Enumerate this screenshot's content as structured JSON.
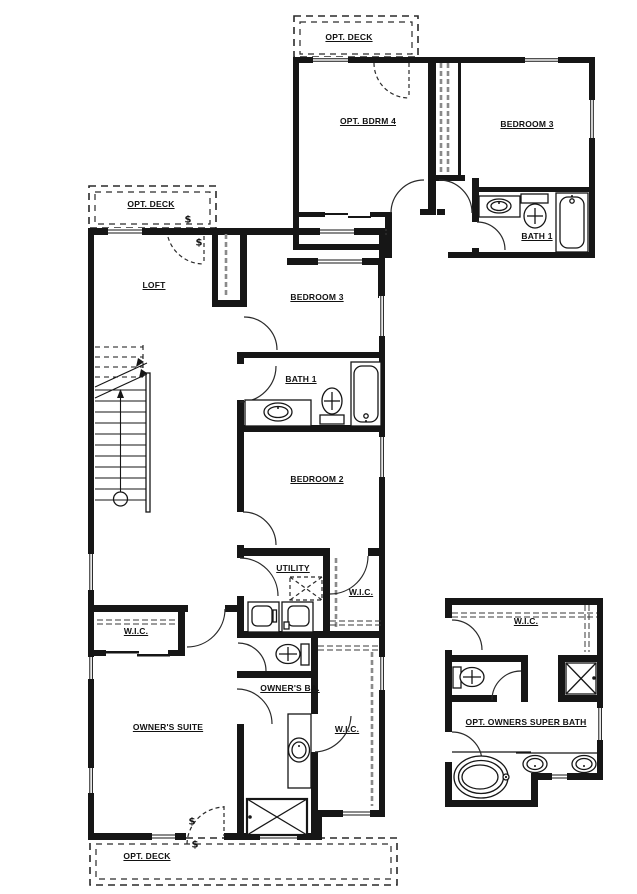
{
  "colors": {
    "walls": "#161616",
    "background": "#ffffff",
    "dash_gray": "#8a8a8a"
  },
  "plans": {
    "upper": {
      "labels": {
        "deck": "OPT. DECK",
        "bdrm4": "OPT. BDRM 4",
        "bedroom3": "BEDROOM 3",
        "bath1": "BATH 1"
      }
    },
    "main": {
      "labels": {
        "deck_top": "OPT. DECK",
        "loft": "LOFT",
        "bedroom3": "BEDROOM 3",
        "bath1": "BATH 1",
        "bedroom2": "BEDROOM 2",
        "utility": "UTILITY",
        "wic_hall": "W.I.C.",
        "wic_left": "W.I.C.",
        "owners_ba": "OWNER'S BA.",
        "owners_suite": "OWNER'S SUITE",
        "wic_owners": "W.I.C.",
        "deck_bottom": "OPT. DECK"
      },
      "symbols": {
        "switch": "$"
      }
    },
    "superbath": {
      "labels": {
        "wic": "W.I.C.",
        "title": "OPT. OWNERS SUPER BATH"
      }
    }
  }
}
